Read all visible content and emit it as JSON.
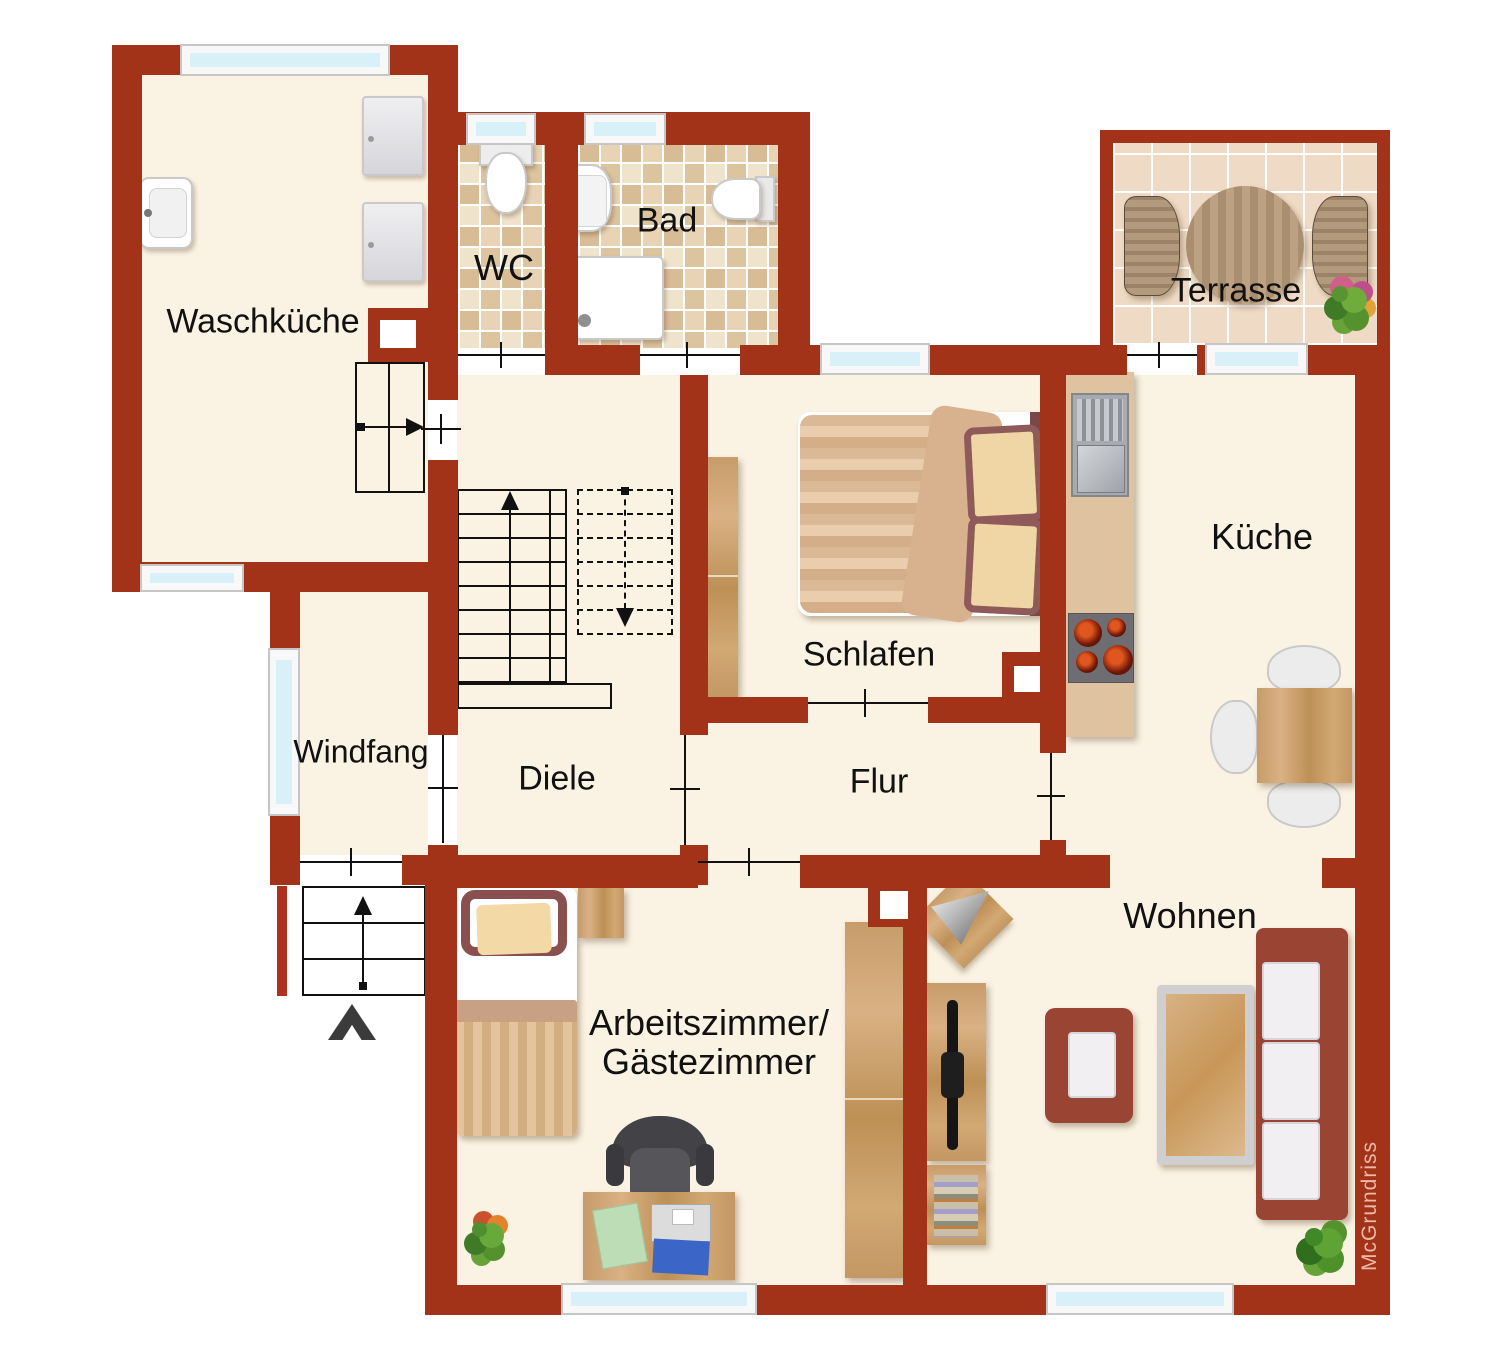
{
  "plan": {
    "watermark": "McGrundriss",
    "rooms": [
      {
        "id": "waschkueche",
        "label": "Waschküche"
      },
      {
        "id": "wc",
        "label": "WC"
      },
      {
        "id": "bad",
        "label": "Bad"
      },
      {
        "id": "terrasse",
        "label": "Terrasse"
      },
      {
        "id": "schlafen",
        "label": "Schlafen"
      },
      {
        "id": "kueche",
        "label": "Küche"
      },
      {
        "id": "windfang",
        "label": "Windfang"
      },
      {
        "id": "diele",
        "label": "Diele"
      },
      {
        "id": "flur",
        "label": "Flur"
      },
      {
        "id": "arbeitszimmer",
        "label": "Arbeitszimmer/",
        "label2": "Gästezimmer"
      },
      {
        "id": "wohnen",
        "label": "Wohnen"
      }
    ],
    "colors": {
      "wall": "#A23318",
      "floor": "#FAF2E3",
      "outside": "#FFFFFF",
      "window_pane": "#D8F1F9",
      "tile_beige": "#EDDCC3",
      "terrace_tile": "#EFDBC5",
      "wood": "#C79C6A",
      "sofa_maroon": "#9A4434",
      "watermark_text": "#EDB9A6"
    },
    "icons": {
      "entrance-arrow-icon": "▲",
      "stairs-up-arrow-icon": "↑",
      "stairs-down-arrow-icon": "↓",
      "door-threshold-icon": "┼"
    },
    "furniture": {
      "waschkueche": [
        "laundry-sink",
        "washing-machine",
        "washing-machine"
      ],
      "wc": [
        "toilet"
      ],
      "bad": [
        "bathroom-sink",
        "toilet",
        "shower"
      ],
      "terrasse": [
        "round-table",
        "chair",
        "chair",
        "plant"
      ],
      "schlafen": [
        "double-bed",
        "wardrobe"
      ],
      "kueche": [
        "kitchen-counter",
        "sink",
        "stove",
        "dining-table",
        "chairs"
      ],
      "arbeitszimmer": [
        "single-bed",
        "nightstand",
        "wardrobe",
        "desk",
        "office-chair",
        "laptop",
        "plant"
      ],
      "wohnen": [
        "corner-speaker",
        "tv-board",
        "tv",
        "bookshelf",
        "armchair",
        "coffee-table",
        "sofa",
        "plant"
      ]
    }
  }
}
